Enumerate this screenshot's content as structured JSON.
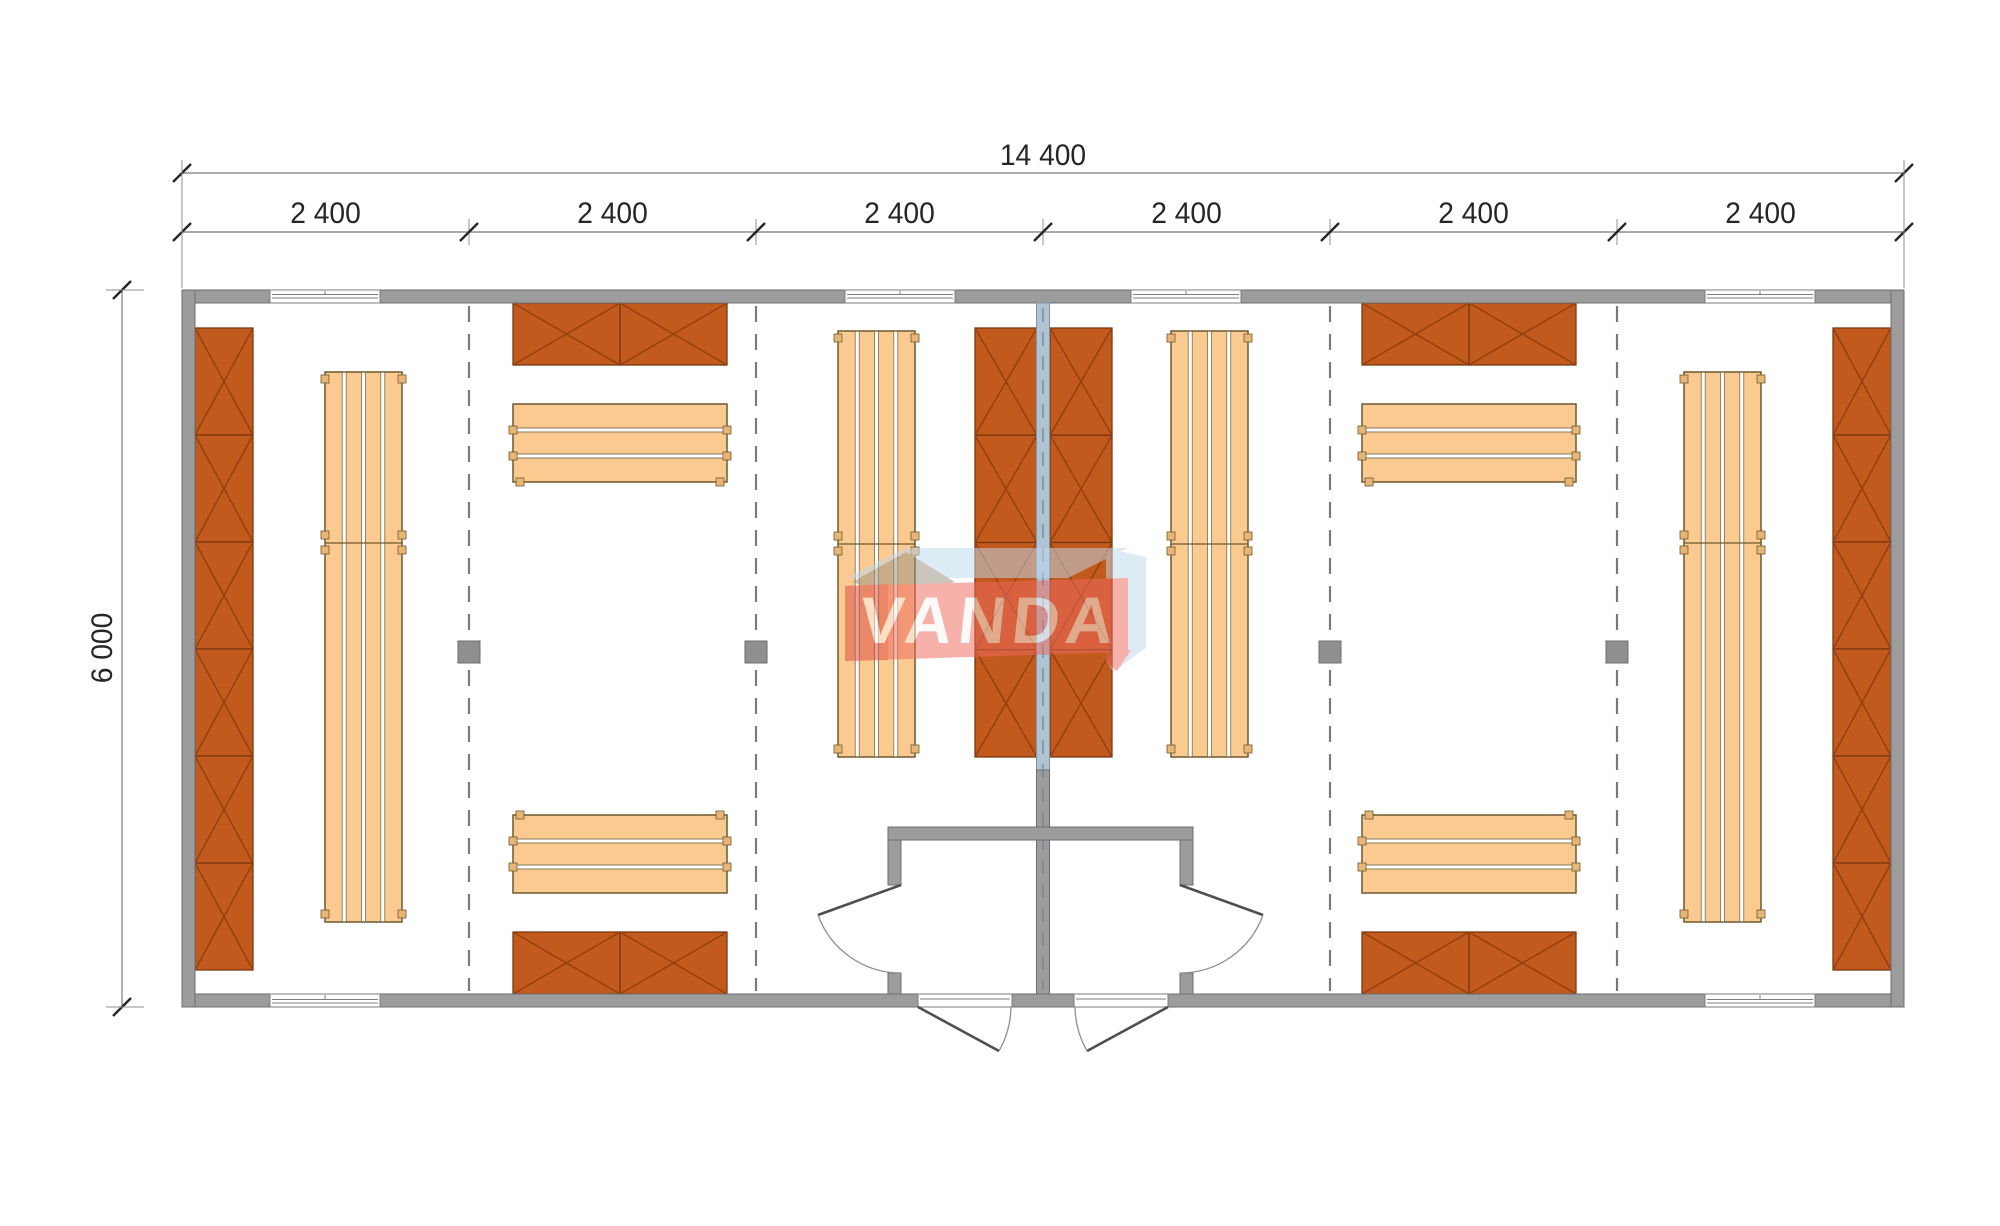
{
  "dimensions": {
    "total_width_label": "14 400",
    "module_labels": [
      "2 400",
      "2 400",
      "2 400",
      "2 400",
      "2 400",
      "2 400"
    ],
    "total_height_label": "6 000"
  },
  "watermark": {
    "text": "VANDA"
  },
  "colors": {
    "background": "#ffffff",
    "wall": "#9C9C9C",
    "wall_edge": "#6E6E6E",
    "partition": "#AFC3D2",
    "partition_edge": "#7E95A6",
    "partition_centerline": "#6F8594",
    "cabinet": "#C2591D",
    "cabinet_edge": "#7A3910",
    "cabinet_x": "#93410F",
    "bench": "#FBCA91",
    "bench_edge": "#6E5A2E",
    "bench_divider": "#8A7A55",
    "bench_foot": "#E8B577",
    "dash_line": "#7A7A7A",
    "post": "#8F8F8F",
    "window_frame": "#7D7D7D",
    "door_leaf": "#4F4F4F",
    "door_arc": "#8F8F8F",
    "dim_line": "#8F8F8F",
    "dim_text": "#262626",
    "wm_blue": "#BFD9ED",
    "wm_olive": "#9A9382",
    "wm_red": "#EE6A60",
    "wm_red_dark": "#D94A41",
    "wm_text": "#FFFFFF"
  }
}
